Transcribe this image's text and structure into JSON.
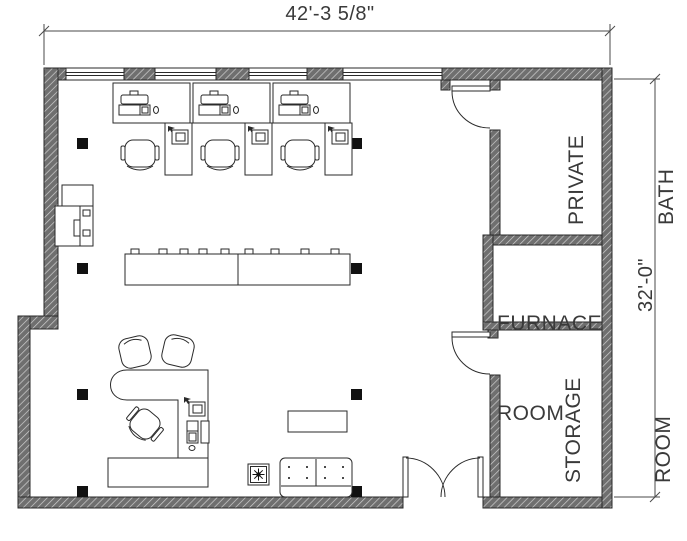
{
  "drawing": {
    "type": "office-floor-plan",
    "dimensions": {
      "width_label": "42'-3 5/8\"",
      "height_label": "32'-0\""
    },
    "rooms": {
      "private_bath": {
        "line1": "PRIVATE",
        "line2": "BATH"
      },
      "furnace_room": {
        "line1": "FURNACE",
        "line2": "ROOM"
      },
      "storage_room": {
        "line1": "STORAGE",
        "line2": "ROOM"
      }
    },
    "colors": {
      "wall_fill": "#6f6f6f",
      "wall_hatch_line": "#cfcfcf",
      "line": "#2a2a2a",
      "text": "#3a3a3a",
      "column": "#111111",
      "background": "#ffffff"
    }
  }
}
